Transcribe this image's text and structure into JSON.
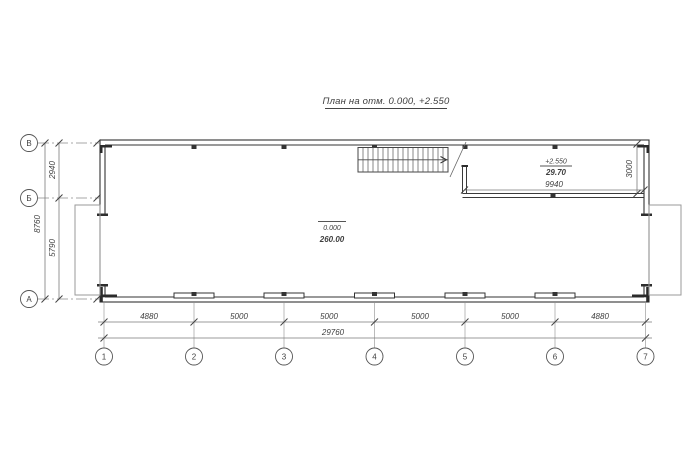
{
  "title": {
    "text": "План на отм. 0.000, +2.550"
  },
  "axes": {
    "rows": [
      {
        "label": "В"
      },
      {
        "label": "Б"
      },
      {
        "label": "А"
      }
    ],
    "cols": [
      {
        "label": "1"
      },
      {
        "label": "2"
      },
      {
        "label": "3"
      },
      {
        "label": "4"
      },
      {
        "label": "5"
      },
      {
        "label": "6"
      },
      {
        "label": "7"
      }
    ]
  },
  "dims": {
    "left": {
      "total": "8760",
      "upper": "2940",
      "lower": "5790"
    },
    "bottom": {
      "segments": [
        "4880",
        "5000",
        "5000",
        "5000",
        "5000",
        "4880"
      ],
      "total": "29760"
    },
    "mezzanine": {
      "width": "9940",
      "depth": "3000"
    }
  },
  "rooms": {
    "main": {
      "level": "0.000",
      "area": "260.00"
    },
    "mezzanine": {
      "level": "+2.550",
      "area": "29.70"
    }
  },
  "colors": {
    "wall": "#333333",
    "dimension_line": "#7a7a7a",
    "extension_line": "#9a9a9a",
    "text": "#3f3f3f"
  }
}
